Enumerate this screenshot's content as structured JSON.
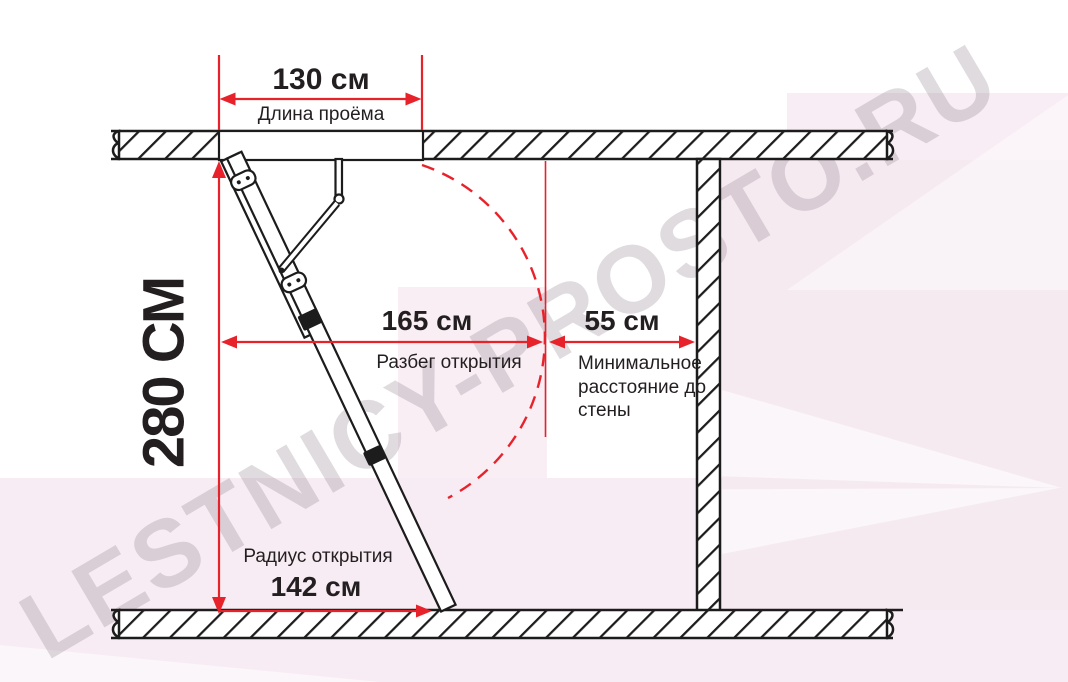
{
  "diagram": {
    "watermark": "LESTNICY-PROSTO.RU",
    "colors": {
      "accent_red": "#e8222b",
      "line_black": "#1c1c1c",
      "background_pink": "#f7ecf3"
    },
    "dims": {
      "opening_length": {
        "value": "130 см",
        "label": "Длина проёма"
      },
      "ceiling_height": {
        "value": "280 СМ"
      },
      "opening_run": {
        "value": "165 см",
        "label": "Разбег открытия"
      },
      "wall_distance": {
        "value": "55 см",
        "label": "Минимальное расстояние до стены"
      },
      "opening_radius": {
        "value": "142 см",
        "label": "Радиус открытия"
      }
    }
  }
}
